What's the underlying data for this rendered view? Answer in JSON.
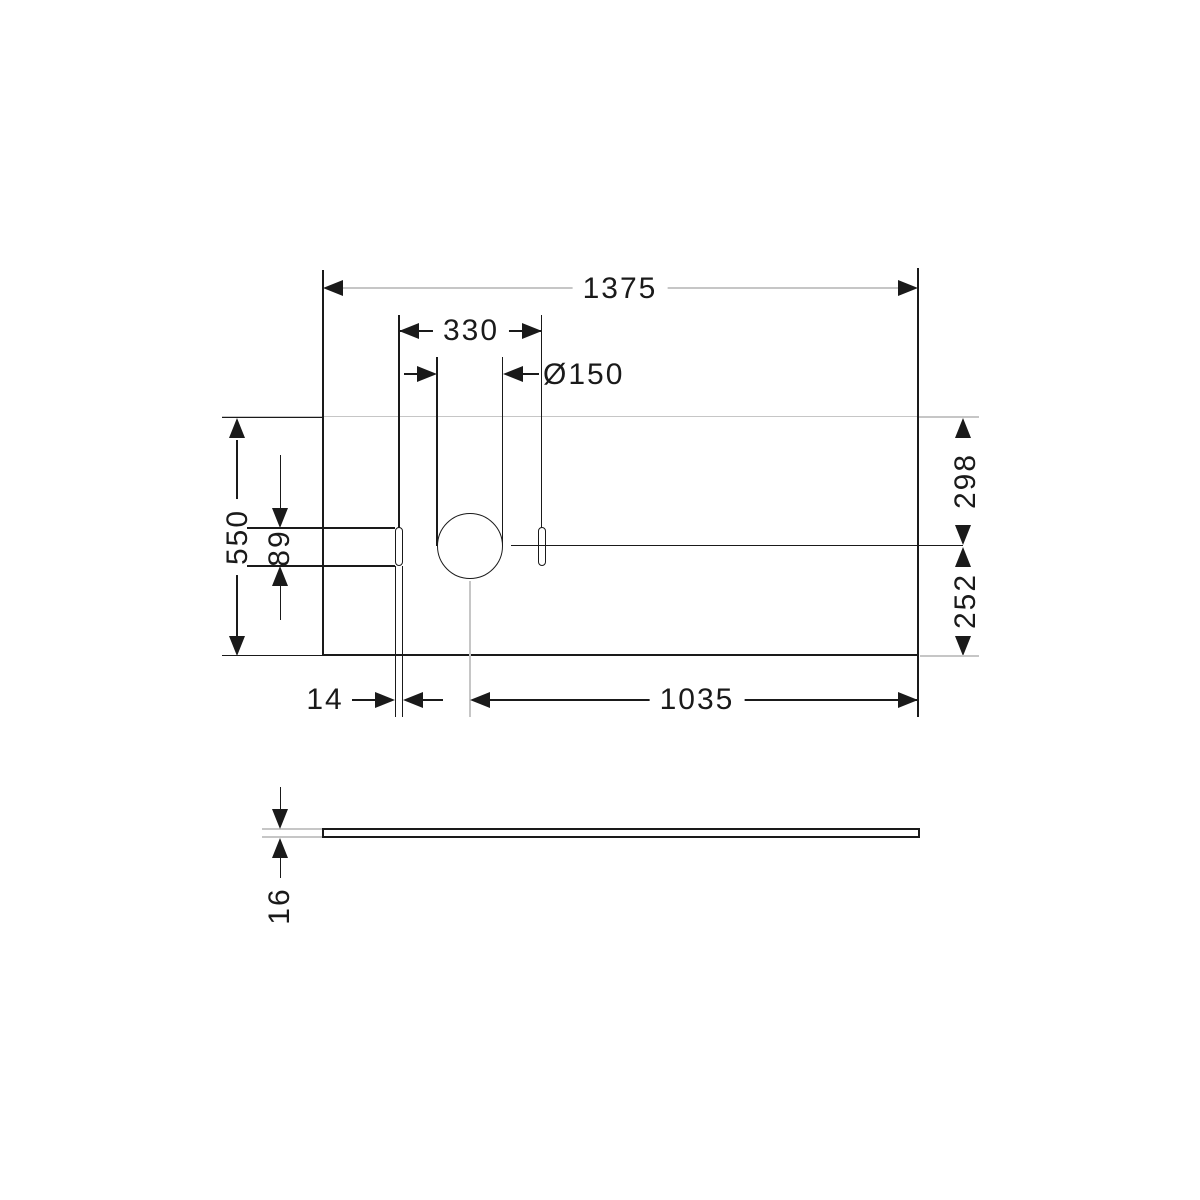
{
  "drawing": {
    "colors": {
      "line": "#1a1a1a",
      "gray": "#c6c6c6",
      "background": "#ffffff"
    },
    "top_view": {
      "width": "1375",
      "offset_330": "330",
      "hole_diameter": "Ø150",
      "depth": "550",
      "slot_length": "89",
      "rear_to_center": "298",
      "center_to_front": "252",
      "slot_width": "14",
      "center_to_right": "1035"
    },
    "side_view": {
      "thickness": "16"
    }
  }
}
